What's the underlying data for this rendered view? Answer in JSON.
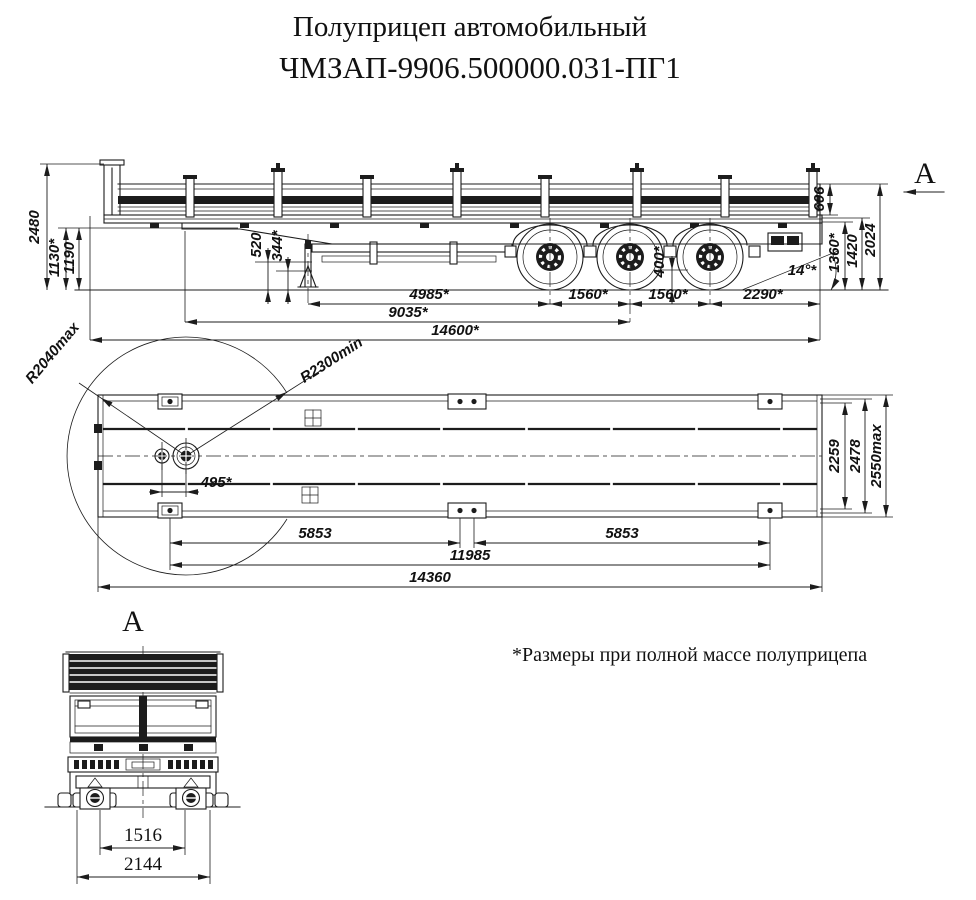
{
  "title": {
    "line1": "Полуприцеп автомобильный",
    "line2": "ЧМЗАП-9906.500000.031-ПГ1"
  },
  "note": "*Размеры при полной массе полуприцепа",
  "colors": {
    "ink": "#1c1c1c",
    "background": "#ffffff"
  },
  "side_view": {
    "view_arrow_label": "A",
    "dims": {
      "height_overall": "2480",
      "coupling_height_laden": "1130*",
      "coupling_height_unladen": "1190",
      "gooseneck_clearance": "520",
      "kingpin_clearance": "344*",
      "axle_frame_clearance": "400*",
      "kingpin_to_axle1": "4985*",
      "axle_spacing_12": "1560*",
      "axle_spacing_23": "1560*",
      "rear_overhang": "2290*",
      "frame_to_bogie": "9035*",
      "length_overall": "14600*",
      "board_height": "606",
      "rear_frame_height_laden": "1360*",
      "rear_frame_height": "1420",
      "rear_height_overall": "2024",
      "departure_angle": "14°*"
    }
  },
  "top_view": {
    "dims": {
      "front_swing_radius": "R2040max",
      "rear_swing_radius": "R2300min",
      "kingpin_hole_offset": "495*",
      "width_inner": "2259",
      "width_frame": "2478",
      "width_overall": "2550max",
      "lashing_span_front": "5853",
      "lashing_span_rear": "5853",
      "lashing_span_outer": "11985",
      "platform_length": "14360"
    }
  },
  "front_view": {
    "label": "A",
    "dims": {
      "track_inner": "1516",
      "track_outer": "2144"
    }
  }
}
